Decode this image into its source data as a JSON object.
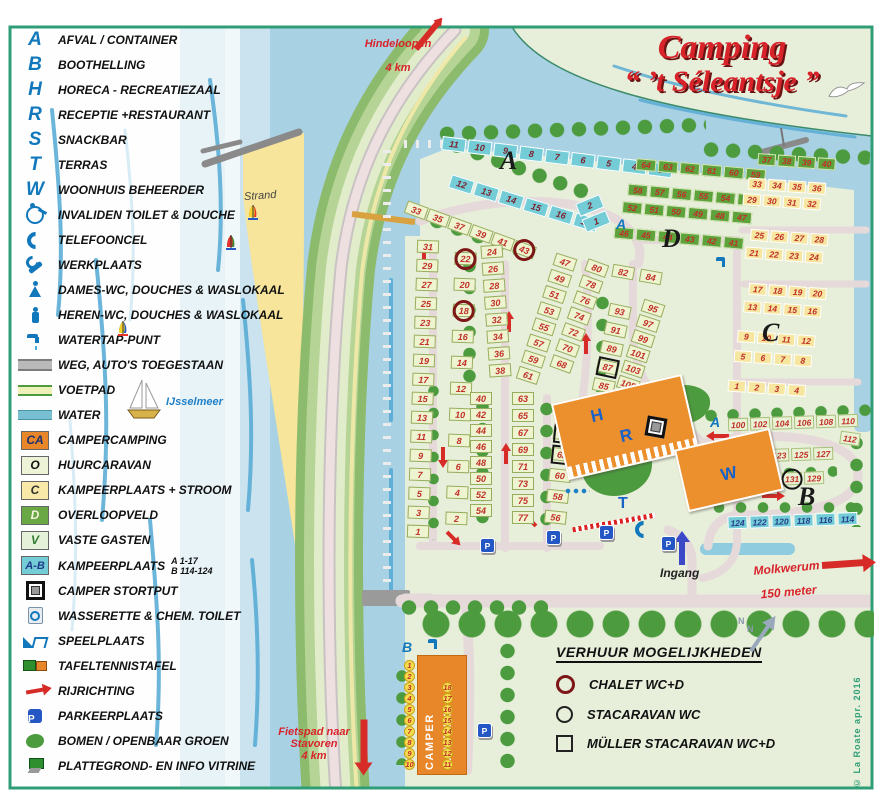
{
  "title": {
    "line1": "Camping",
    "line2": "“ ’t Séleantsje ”"
  },
  "legend": {
    "items": [
      {
        "key": "A",
        "t": "letter",
        "label": "AFVAL / CONTAINER"
      },
      {
        "key": "B",
        "t": "letter",
        "label": "BOOTHELLING"
      },
      {
        "key": "H",
        "t": "letter",
        "label": "HORECA - RECREATIEZAAL"
      },
      {
        "key": "R",
        "t": "letter",
        "label": "RECEPTIE +RESTAURANT"
      },
      {
        "key": "S",
        "t": "letter",
        "label": "SNACKBAR"
      },
      {
        "key": "T",
        "t": "letter",
        "label": "TERRAS"
      },
      {
        "key": "W",
        "t": "letter",
        "label": "WOONHUIS BEHEERDER"
      },
      {
        "icon": "wheelchair",
        "label": "INVALIDEN TOILET & DOUCHE"
      },
      {
        "icon": "phone",
        "label": "TELEFOONCEL"
      },
      {
        "icon": "wrench",
        "label": "WERKPLAATS"
      },
      {
        "icon": "female",
        "label": "DAMES-WC, DOUCHES & WASLOKAAL"
      },
      {
        "icon": "male",
        "label": "HEREN-WC, DOUCHES & WASLOKAAL"
      },
      {
        "icon": "tap",
        "label": "WATERTAP-PUNT"
      },
      {
        "icon": "road",
        "label": "WEG, AUTO'S TOEGESTAAN"
      },
      {
        "icon": "voetpad",
        "label": "VOETPAD"
      },
      {
        "icon": "water",
        "label": "WATER"
      },
      {
        "key": "CA",
        "t": "swatch",
        "sw": "ca",
        "label": "CAMPERCAMPING"
      },
      {
        "key": "O",
        "t": "swatch",
        "sw": "o",
        "label": "HUURCARAVAN"
      },
      {
        "key": "C",
        "t": "swatch",
        "sw": "c",
        "label": "KAMPEERPLAATS + STROOM"
      },
      {
        "key": "D",
        "t": "swatch",
        "sw": "d",
        "label": "OVERLOOPVELD"
      },
      {
        "key": "V",
        "t": "swatch",
        "sw": "v",
        "label": "VASTE GASTEN"
      },
      {
        "key": "A-B",
        "t": "swatch",
        "sw": "ab",
        "label": "KAMPEERPLAATS",
        "sub": "A 1-17\nB 114-124"
      },
      {
        "icon": "stortput",
        "label": "CAMPER STORTPUT"
      },
      {
        "icon": "wasserette",
        "label": "WASSERETTE & CHEM. TOILET"
      },
      {
        "icon": "speelplaats",
        "label": "SPEELPLAATS"
      },
      {
        "icon": "tafeltennis",
        "label": "TAFELTENNISTAFEL"
      },
      {
        "icon": "arrow",
        "label": "RIJRICHTING"
      },
      {
        "icon": "parking",
        "label": "PARKEERPLAATS"
      },
      {
        "icon": "tree",
        "label": "BOMEN / OPENBAAR GROEN"
      },
      {
        "icon": "infoboard",
        "label": "PLATTEGROND- EN INFO VITRINE"
      }
    ]
  },
  "rental": {
    "heading": "VERHUUR MOGELIJKHEDEN",
    "items": [
      {
        "sym": "chalet",
        "label": "CHALET  WC+D"
      },
      {
        "sym": "stacaravan",
        "label": "STACARAVAN  WC"
      },
      {
        "sym": "muller",
        "label": "MÜLLER STACARAVAN  WC+D"
      }
    ]
  },
  "map": {
    "labels": {
      "hindeloopen": "Hindeloopen",
      "hindeloopen_dist": "4 km",
      "stavoren": "Fietspad naar\nStavoren\n4 km",
      "molkwerum": "Molkwerum",
      "molkwerum_dist": "150 meter",
      "ingang": "Ingang",
      "strand": "Strand",
      "ijsselmeer": "IJsselmeer",
      "camper_line1": "CAMPER",
      "camper_line2": "CAMPING",
      "north": "N",
      "p": "P",
      "copyright": "© La Roate  apr. 2016"
    },
    "section_letters": {
      "a": "A",
      "b": "B",
      "c": "C",
      "d": "D"
    },
    "building_letters": {
      "h": "H",
      "r": "R",
      "s": "S",
      "t": "T",
      "w": "W"
    },
    "service_letters": {
      "afval": "A",
      "boothelling": "B"
    },
    "plots": {
      "a_top": [
        "11",
        "10",
        "9",
        "8",
        "7",
        "6",
        "5",
        "4",
        "3"
      ],
      "a_diag": [
        "12",
        "13",
        "14",
        "15",
        "16",
        "17"
      ],
      "a_side": [
        "2",
        "1"
      ],
      "d_r1": [
        "64",
        "63",
        "62",
        "61",
        "60",
        "59"
      ],
      "d_r2": [
        "58",
        "57",
        "56",
        "55",
        "54",
        "53"
      ],
      "d_r3": [
        "52",
        "51",
        "50",
        "49",
        "48",
        "47"
      ],
      "d_r4": [
        "46",
        "45",
        "44",
        "43",
        "42",
        "41"
      ],
      "c_green": [
        "37",
        "38",
        "39",
        "40"
      ],
      "c_r1": [
        "33",
        "34",
        "35",
        "36"
      ],
      "c_r2": [
        "29",
        "30",
        "31",
        "32"
      ],
      "c_r3": [
        "25",
        "26",
        "27",
        "28"
      ],
      "c_r4": [
        "21",
        "22",
        "23",
        "24"
      ],
      "c_r5": [
        "17",
        "18",
        "19",
        "20"
      ],
      "c_r6": [
        "13",
        "14",
        "15",
        "16"
      ],
      "c_r7": [
        "9",
        "10",
        "11",
        "12"
      ],
      "c_r8": [
        "5",
        "6",
        "7",
        "8"
      ],
      "c_r9": [
        "1",
        "2",
        "3",
        "4"
      ],
      "b_r1": [
        "100",
        "102",
        "104",
        "106",
        "108",
        "110"
      ],
      "b_single": "112",
      "b_r2": [
        "121",
        "123",
        "125",
        "127"
      ],
      "b_r3": [
        "135",
        "133",
        {
          "l": "131",
          "m": "s"
        },
        "129"
      ],
      "b_r4": [
        "124",
        "122",
        "120",
        "118",
        "116",
        "114"
      ],
      "v_slant": [
        "33",
        "35",
        "37",
        "39",
        "41",
        {
          "l": "43",
          "m": "c"
        }
      ],
      "v_c1": [
        "31",
        "29",
        "27",
        "25",
        "23",
        "21",
        "19",
        "17",
        "15",
        "13",
        "11",
        "9",
        "7",
        "5",
        "3",
        "1"
      ],
      "v_c2": [
        {
          "l": "22",
          "m": "c"
        },
        "20",
        {
          "l": "18",
          "m": "c"
        },
        "16",
        "14",
        "12",
        "10",
        "8",
        "6",
        "4",
        "2"
      ],
      "v_c3a": [
        "24",
        "26",
        "28",
        "30",
        "32",
        "34",
        "36",
        "38"
      ],
      "v_c3b": [
        "40",
        "42",
        "44",
        "46",
        "48",
        "50",
        "52",
        "54"
      ],
      "v_c4a": [
        "47",
        "49",
        "51",
        "53",
        "55",
        "57",
        "59",
        "61"
      ],
      "v_c4b": [
        "63",
        "65",
        "67",
        "69",
        "71",
        "73",
        "75",
        "77"
      ],
      "v_c5a": [
        "80",
        "78",
        "76",
        "74",
        "72",
        "70",
        "68"
      ],
      "v_c5b": [
        {
          "l": "66",
          "m": "c"
        },
        {
          "l": "64",
          "m": "mm"
        },
        {
          "l": "62",
          "m": "mm"
        },
        "60",
        "58",
        "56"
      ],
      "v_tr": [
        "82",
        "84"
      ],
      "v_c6a": [
        "93",
        "91",
        "89",
        {
          "l": "87",
          "m": "mm"
        },
        "85"
      ],
      "v_c6b": [
        "95",
        "97",
        "99",
        "101",
        "103",
        "105"
      ],
      "v_113": "113",
      "v_83": "83",
      "v_81": [
        {
          "l": "81",
          "m": "s"
        }
      ],
      "camper_l": [
        "1",
        "2",
        "3",
        "4",
        "5",
        "6",
        "7",
        "8",
        "9",
        "10"
      ],
      "camper_r": [
        "18",
        "17",
        "16",
        "15",
        "14",
        "13",
        "12",
        "11"
      ]
    }
  }
}
